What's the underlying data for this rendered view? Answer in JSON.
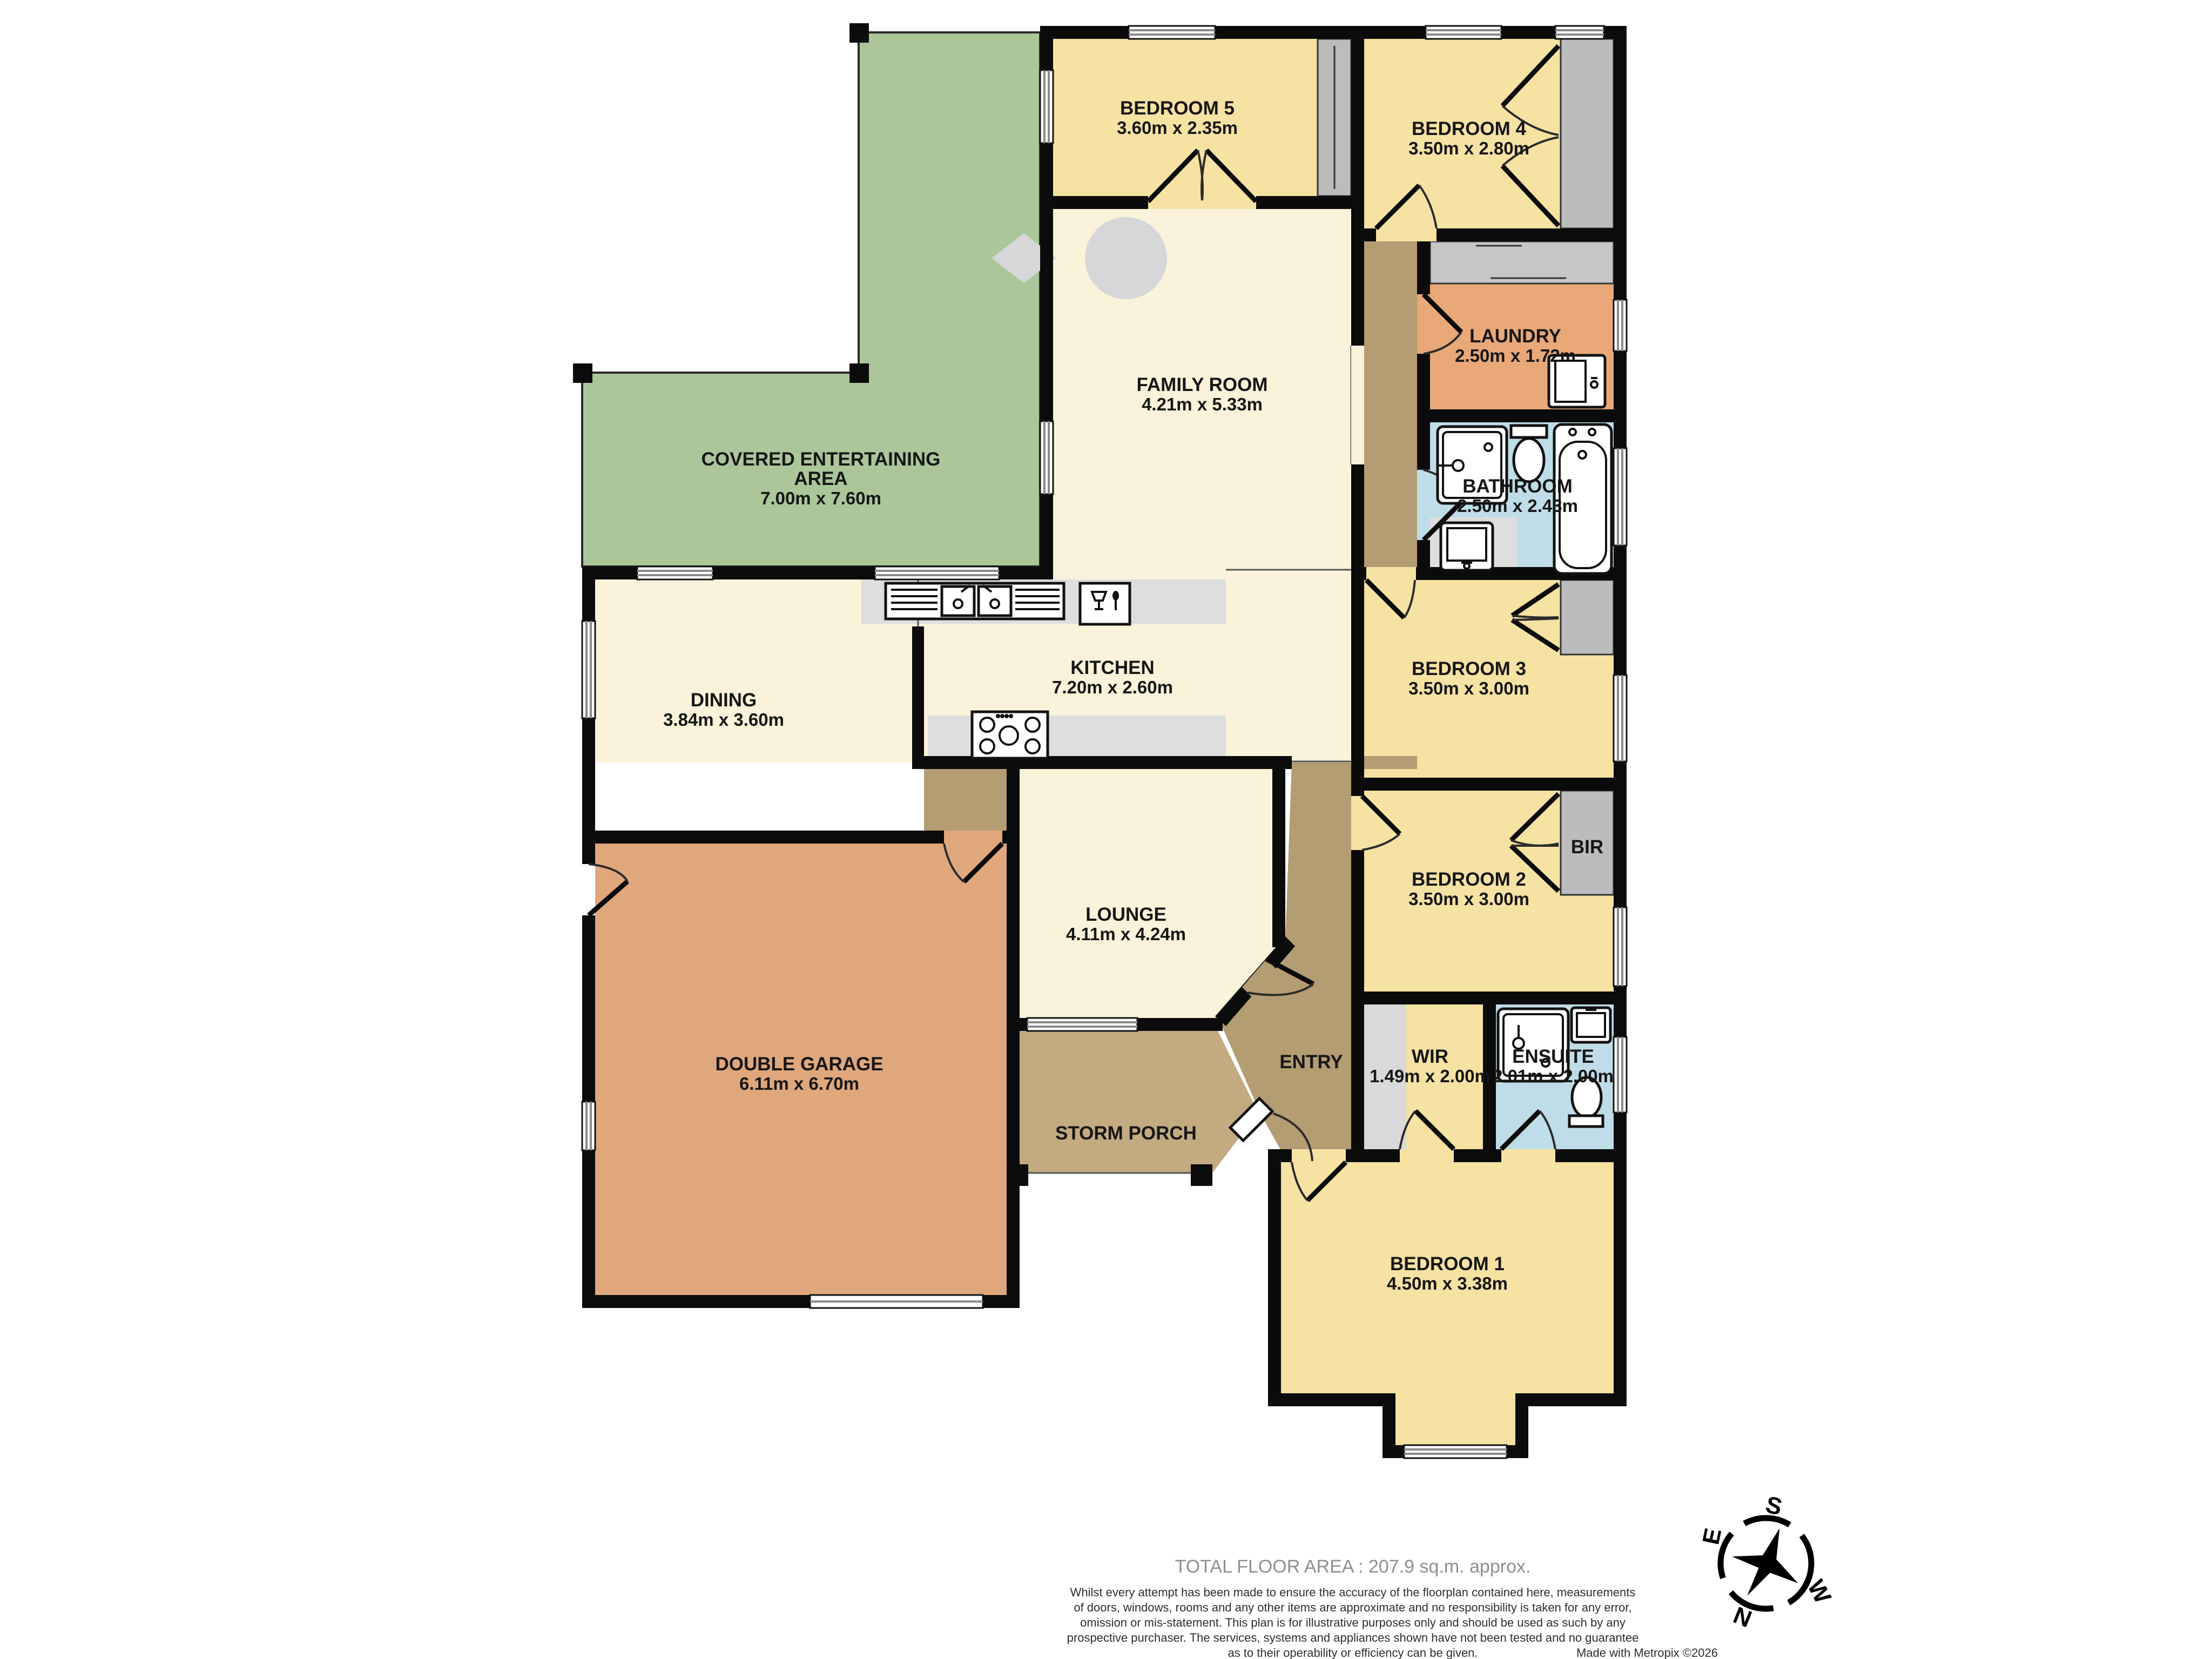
{
  "rooms": {
    "covered": {
      "line1": "COVERED ENTERTAINING",
      "line2": "AREA",
      "dims": "7.00m  x 7.60m"
    },
    "bedroom5": {
      "name": "BEDROOM 5",
      "dims": "3.60m  x 2.35m"
    },
    "bedroom4": {
      "name": "BEDROOM 4",
      "dims": "3.50m  x 2.80m"
    },
    "family": {
      "name": "FAMILY ROOM",
      "dims": "4.21m  x 5.33m"
    },
    "laundry": {
      "name": "LAUNDRY",
      "dims": "2.50m  x 1.72m"
    },
    "bathroom": {
      "name": "BATHROOM",
      "dims": "2.50m  x 2.43m"
    },
    "dining": {
      "name": "DINING",
      "dims": "3.84m  x 3.60m"
    },
    "kitchen": {
      "name": "KITCHEN",
      "dims": "7.20m  x 2.60m"
    },
    "bedroom3": {
      "name": "BEDROOM 3",
      "dims": "3.50m  x 3.00m"
    },
    "bedroom2": {
      "name": "BEDROOM 2",
      "dims": "3.50m  x 3.00m"
    },
    "bir": {
      "name": "BIR"
    },
    "lounge": {
      "name": "LOUNGE",
      "dims": "4.11m  x 4.24m"
    },
    "garage": {
      "name": "DOUBLE GARAGE",
      "dims": "6.11m  x 6.70m"
    },
    "entry": {
      "name": "ENTRY"
    },
    "storm_porch": {
      "name": "STORM PORCH"
    },
    "wir": {
      "name": "WIR",
      "dims": "1.49m  x 2.00m"
    },
    "ensuite": {
      "name": "ENSUITE",
      "dims": "2.01m  x 2.00m"
    },
    "bedroom1": {
      "name": "BEDROOM 1",
      "dims": "4.50m  x 3.38m"
    }
  },
  "footer": {
    "total_area": "TOTAL FLOOR AREA : 207.9 sq.m. approx.",
    "disclaimer_lines": [
      "Whilst every attempt has been made to ensure the accuracy of the floorplan contained here, measurements",
      "of doors, windows, rooms and any other items are approximate and no responsibility is taken for any error,",
      "omission or mis-statement. This plan is for illustrative purposes only and should be used as such by any",
      "prospective purchaser. The services, systems and appliances shown have not been tested and no guarantee",
      "as to their operability or efficiency can be given."
    ],
    "credit": "Made with Metropix ©2026"
  },
  "compass": {
    "n": "N",
    "s": "S",
    "e": "E",
    "w": "W"
  },
  "colors": {
    "wall": "#0b0b0b",
    "bedroom_yellow": "#f6e2a3",
    "living_cream": "#faf3da",
    "veranda_green": "#abc79a",
    "laundry_orange": "#e8a877",
    "garage_tan": "#e0a77d",
    "wet_blue": "#bedde8",
    "hall_brown": "#b49c73",
    "porch_tan": "#c3aa81",
    "robe_grey": "#bcbcbe",
    "bench_grey": "#dedede"
  }
}
